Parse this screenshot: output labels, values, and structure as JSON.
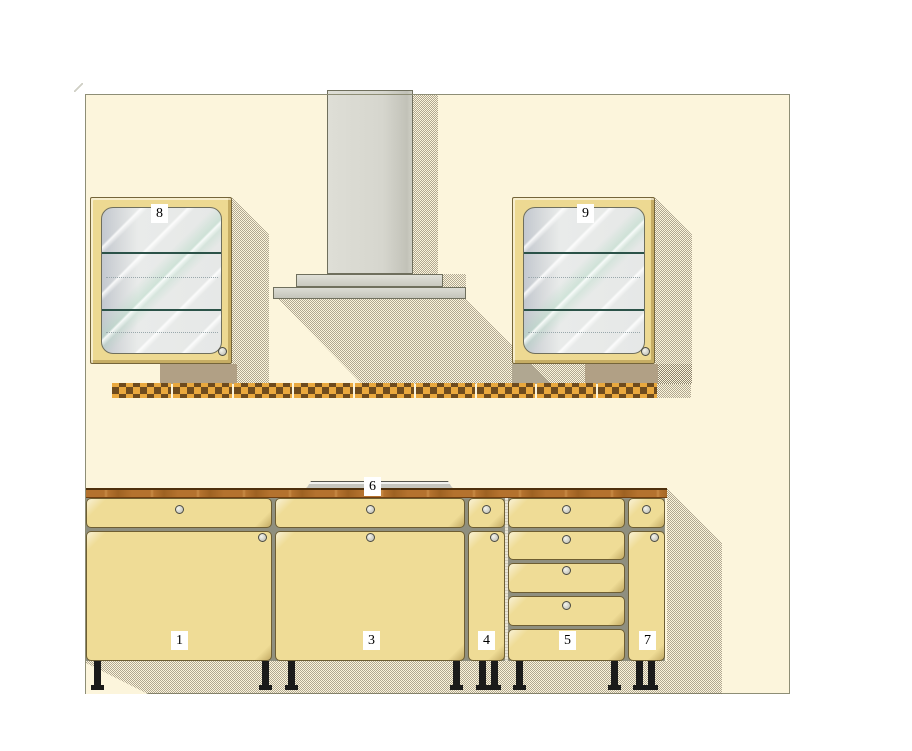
{
  "labels": {
    "base_cabinet_1": "1",
    "base_cabinet_3": "3",
    "base_cabinet_4": "4",
    "drawer_unit_5": "5",
    "cooktop_6": "6",
    "base_cabinet_7": "7",
    "wall_cabinet_8": "8",
    "wall_cabinet_9": "9"
  },
  "colors": {
    "background": "#FFFFFF",
    "wall": "#FCF5DC",
    "wall_border": "#8E8E76",
    "cabinet_face": "#EFDC96",
    "cabinet_frame": "#EDD992",
    "countertop_wood": "#B4722E",
    "tile_amber": "#E9A83E",
    "tile_dark_check": "#6E4B1E",
    "hood_gray": "#D6D6CE",
    "glass": "#E7E9E8",
    "shelf_line": "#2B5248",
    "shadow_hatch": "#6B614E",
    "solid_shadow": "#B1A085",
    "legs": "#1A1A1A"
  }
}
